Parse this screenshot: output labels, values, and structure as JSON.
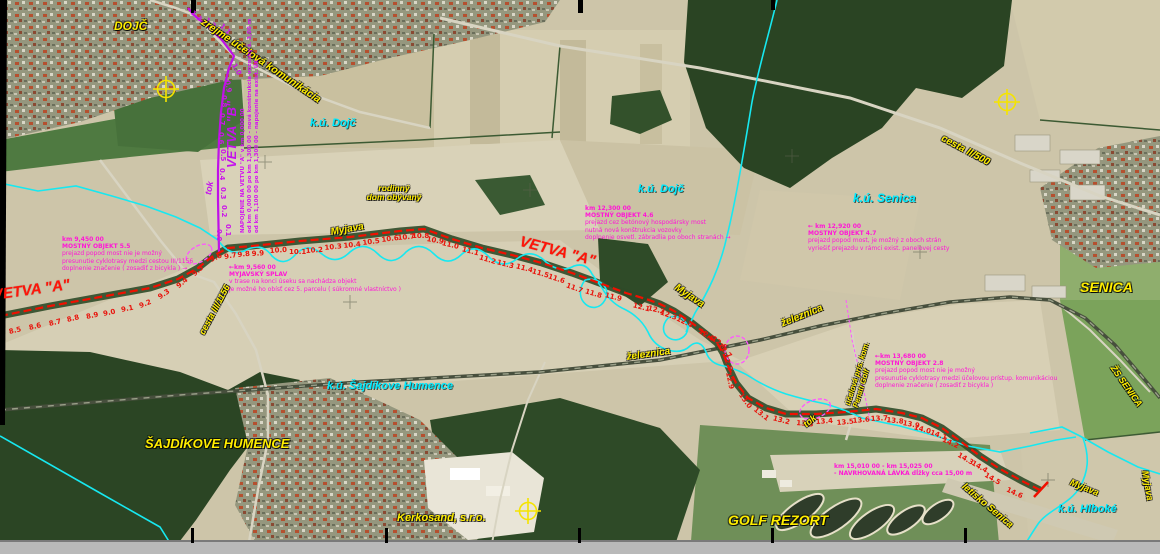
{
  "route_a": {
    "name": "VETVA \"A\"",
    "chainage": [
      [
        "8.5",
        10,
        328,
        -14
      ],
      [
        "8.6",
        30,
        324,
        -14
      ],
      [
        "8.7",
        50,
        320,
        -14
      ],
      [
        "8.8",
        68,
        316,
        -14
      ],
      [
        "8.9",
        87,
        313,
        -12
      ],
      [
        "9.0",
        104,
        310,
        -12
      ],
      [
        "9.1",
        122,
        306,
        -12
      ],
      [
        "9.2",
        141,
        302,
        -22
      ],
      [
        "9.3",
        161,
        293,
        -34
      ],
      [
        "9.4",
        180,
        282,
        -40
      ],
      [
        "9.5",
        196,
        270,
        -42
      ],
      [
        "9.6",
        212,
        256,
        -25
      ],
      [
        "9.7",
        225,
        253,
        -10
      ],
      [
        "9.8",
        238,
        251,
        -6
      ],
      [
        "9.9",
        252,
        250,
        -4
      ],
      [
        "10.0",
        270,
        247,
        -4
      ],
      [
        "10.1",
        289,
        248,
        0
      ],
      [
        "10.2",
        306,
        247,
        -4
      ],
      [
        "10.3",
        325,
        244,
        -6
      ],
      [
        "10.4",
        344,
        242,
        -6
      ],
      [
        "10.5",
        363,
        239,
        -7
      ],
      [
        "10.6",
        382,
        236,
        -7
      ],
      [
        "10.7",
        398,
        234,
        -5
      ],
      [
        "10.8",
        412,
        232,
        0
      ],
      [
        "10.9",
        426,
        235,
        10
      ],
      [
        "11.0",
        441,
        239,
        13
      ],
      [
        "11.1",
        461,
        245,
        15
      ],
      [
        "11.2",
        478,
        253,
        17
      ],
      [
        "11.3",
        496,
        258,
        15
      ],
      [
        "11.4",
        515,
        262,
        15
      ],
      [
        "11.5",
        531,
        267,
        16
      ],
      [
        "11.6",
        547,
        272,
        18
      ],
      [
        "11.7",
        565,
        281,
        20
      ],
      [
        "11.8",
        584,
        287,
        17
      ],
      [
        "11.9",
        604,
        291,
        14
      ],
      [
        "12.1",
        632,
        301,
        15
      ],
      [
        "12.2",
        647,
        304,
        13
      ],
      [
        "12.3",
        659,
        308,
        20
      ],
      [
        "12.4",
        675,
        314,
        26
      ],
      [
        "12.5",
        697,
        326,
        32
      ],
      [
        "12.6",
        710,
        333,
        38
      ],
      [
        "12.7",
        716,
        339,
        48
      ],
      [
        "12.8",
        721,
        348,
        70
      ],
      [
        "12.9",
        724,
        365,
        78
      ],
      [
        "13.0",
        737,
        388,
        55
      ],
      [
        "13.1",
        752,
        404,
        38
      ],
      [
        "13.2",
        772,
        414,
        15
      ],
      [
        "13.3",
        796,
        419,
        5
      ],
      [
        "13.4",
        816,
        418,
        -4
      ],
      [
        "13.5",
        837,
        419,
        -5
      ],
      [
        "13.6",
        853,
        417,
        -5
      ],
      [
        "13.7",
        871,
        415,
        -3
      ],
      [
        "13.8",
        886,
        416,
        6
      ],
      [
        "13.9",
        902,
        419,
        10
      ],
      [
        "14.0",
        913,
        423,
        16
      ],
      [
        "14.1",
        929,
        428,
        20
      ],
      [
        "14.2",
        941,
        435,
        25
      ],
      [
        "14.3",
        956,
        450,
        30
      ],
      [
        "14.4",
        970,
        458,
        30
      ],
      [
        "14.5",
        983,
        470,
        30
      ],
      [
        "14.6",
        1005,
        485,
        25
      ]
    ]
  },
  "route_b": {
    "name": "VETVA \"B\"",
    "chainage": [
      [
        "0.0",
        215,
        221,
        90
      ],
      [
        "0.1",
        224,
        216,
        90
      ],
      [
        "0.2",
        220,
        197,
        90
      ],
      [
        "0.3",
        219,
        179,
        90
      ],
      [
        "0.4",
        218,
        160,
        90
      ],
      [
        "0.5",
        219,
        141,
        90
      ],
      [
        "0.6",
        217,
        124,
        90
      ],
      [
        "0.7",
        218,
        105,
        90
      ],
      [
        "0.8",
        220,
        87,
        90
      ],
      [
        "0.9",
        223,
        73,
        80
      ],
      [
        "1.0",
        230,
        58,
        60
      ],
      [
        "1.1",
        218,
        20,
        42
      ],
      [
        "1.2",
        203,
        14,
        42
      ],
      [
        "1.3",
        189,
        7,
        42
      ]
    ],
    "note_lines": [
      "NAPOJENIE NA VETVU \"A\" v km 0,000 00",
      "od km 0,000 00 po km 1,300 00 - nová konštrukcia vozovky š. 3,00 m",
      "od km 1,100 00 po km 1,300 00 - napojenie na exist. ÚK"
    ]
  },
  "notes": {
    "bridge_9450": {
      "lines": [
        "km 9,450 00",
        "MOSTNÝ OBJEKT 5.5",
        "prejazd popod most nie je možný",
        "presunutie cyklotrasy medzi cestou III/1156",
        "doplnenie značenie ( zosadiť z bicykla ) →"
      ]
    },
    "splav_9560": {
      "lines": [
        "←km 9,560 00",
        "MYJAVSKÝ SPLAV",
        "v trase na konci úseku sa nachádza objekt",
        "je možné ho obísť cez 5. parcelu ( súkromné vlastníctvo )"
      ]
    },
    "bridge_12300": {
      "lines": [
        "km 12,300 00",
        "MOSTNÝ OBJEKT 4.6",
        "prejazd cez betónový hospodársky most",
        "nutná nová konštrukcia vozovky",
        "doplnenie osvetl. zábradlia po oboch stranách →"
      ]
    },
    "bridge_12920": {
      "lines": [
        "← km 12,920 00",
        "MOSTNÝ OBJEKT 4.7",
        "prejazd popod most, je možný z oboch strán",
        "vyriešiť prejazdu v rámci exist. panelovej cesty"
      ]
    },
    "bridge_13680": {
      "lines": [
        "←km 13,680 00",
        "MOSTNÝ OBJEKT 2.8",
        "prejazd popod most nie je možný",
        "presunutie cyklotrasy medzi účelovou prístup. komunikáciou",
        "doplnenie značenie ( zosadiť z bicykla )"
      ]
    },
    "lavka_15010": {
      "lines": [
        "km 15,010 00 - km 15,025 00",
        "- NAVRHOVANÁ LÁVKA dĺžky cca 15,00 m"
      ]
    }
  },
  "places": {
    "dojc": "DOJČ",
    "senica": "SENICA",
    "sajdikove_humence": "ŠAJDÍKOVE HUMENCE",
    "golf_rezort": "GOLF REZORT",
    "kerkosand": "Kerkosand, s.r.o.",
    "zs_senica": "ŽS SENICA",
    "letisko": "letisko Senica"
  },
  "cadastre": {
    "dojc_w": "k.ú. Dojč",
    "dojc_e": "k.ú. Dojč",
    "senica": "k.ú. Senica",
    "sajdikove": "k.ú. Šajdíkove Humence",
    "hlboke": "k.ú. Hlboké"
  },
  "features": {
    "myjava_w": "Myjava",
    "myjava_mid": "Myjava",
    "myjava_se": "Myjava",
    "myjava_e": "Myjava",
    "zeleznica_w": "železnica",
    "zeleznica_e": "železnica",
    "cesta_iii": "cesta III/1156",
    "cesta_ii": "cesta II/500",
    "ucelova": "zrejme účelová komunikácia",
    "tok_b": "tok",
    "tok_golf": "tok",
    "penati_1": "účelová prís. kom.",
    "penati_2": "Penati Golf",
    "rodinny_1": "rodinný",
    "rodinny_2": "dom obývaný"
  },
  "colors": {
    "route_a": "#ff1408",
    "route_b": "#c412ec",
    "annotation_magenta": "#ff17d6",
    "place_yellow": "#ffee00",
    "cadastre_cyan": "#00eaff"
  }
}
